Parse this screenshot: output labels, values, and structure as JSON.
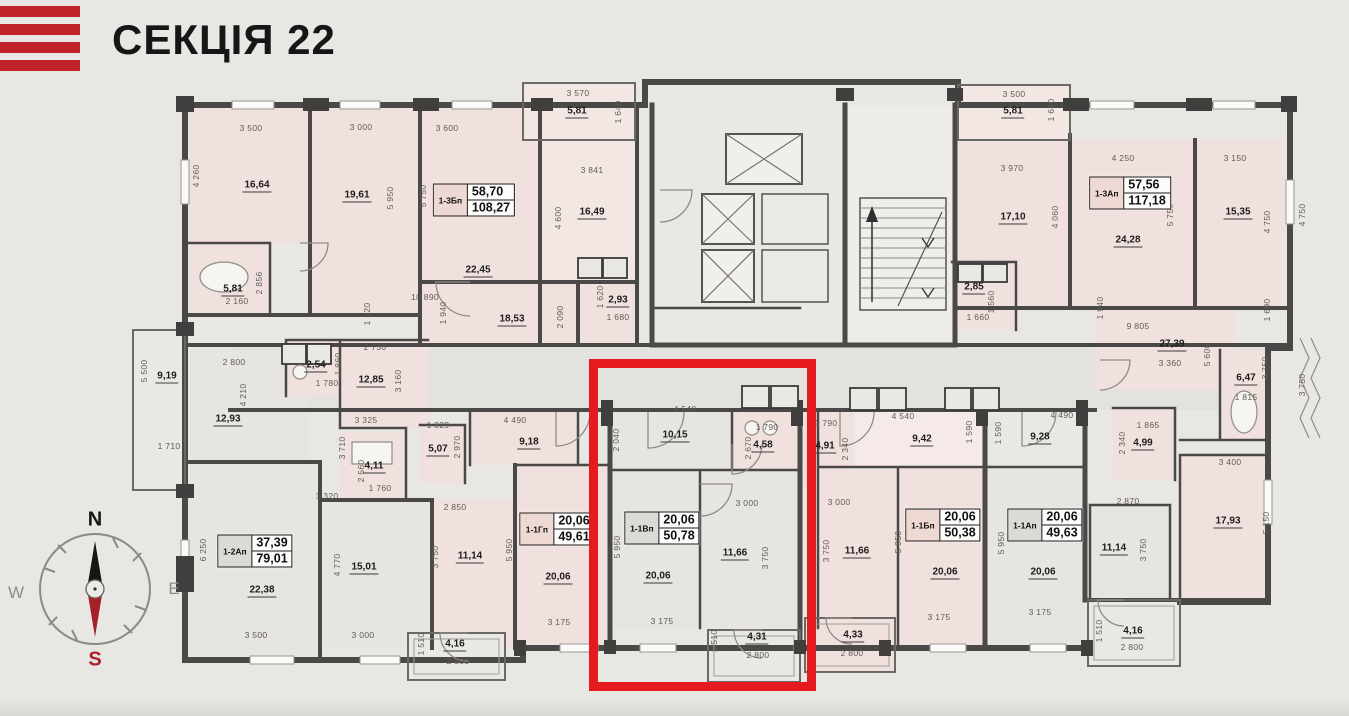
{
  "header": {
    "title": "СЕКЦІЯ 22"
  },
  "colors": {
    "highlight_red": "#e41a1f",
    "logo_red": "#bf2329",
    "room_pink": "#f1e1de",
    "room_gray": "#e6e5e1",
    "wall": "#4a4947"
  },
  "compass": {
    "n": "N",
    "s": "S",
    "w": "W",
    "e": "E"
  },
  "apartments": [
    {
      "code": "1-3Бп",
      "living": "58,70",
      "total": "108,27",
      "cell": "pink"
    },
    {
      "code": "1-3Ап",
      "living": "57,56",
      "total": "117,18",
      "cell": "pink"
    },
    {
      "code": "1-2Ап",
      "living": "37,39",
      "total": "79,01",
      "cell": "gray"
    },
    {
      "code": "1-1Гп",
      "living": "20,06",
      "total": "49,61",
      "cell": "pink"
    },
    {
      "code": "1-1Вп",
      "living": "20,06",
      "total": "50,78",
      "cell": "gray"
    },
    {
      "code": "1-1Бп",
      "living": "20,06",
      "total": "50,38",
      "cell": "pink"
    },
    {
      "code": "1-1Ап",
      "living": "20,06",
      "total": "49,63",
      "cell": "gray"
    }
  ],
  "areas": [
    "16,64",
    "19,61",
    "5,81",
    "22,45",
    "16,49",
    "18,53",
    "2,93",
    "5,81",
    "5,81",
    "17,10",
    "24,28",
    "15,35",
    "2,85",
    "9,19",
    "12,93",
    "2,54",
    "12,85",
    "4,11",
    "5,07",
    "9,18",
    "11,14",
    "20,06",
    "10,15",
    "4,58",
    "20,06",
    "11,66",
    "4,31",
    "4,91",
    "9,42",
    "11,66",
    "20,06",
    "4,33",
    "9,28",
    "20,06",
    "11,14",
    "17,93",
    "27,39",
    "6,47",
    "4,99",
    "4,16",
    "4,16",
    "15,01",
    "22,38"
  ],
  "dims": [
    "3 500",
    "3 000",
    "3 600",
    "4 260",
    "5 950",
    "5 750",
    "2 160",
    "2 856",
    "10 890",
    "1 940",
    "2 090",
    "1 620",
    "1 680",
    "3 570",
    "1 640",
    "3 841",
    "4 600",
    "5 500",
    "1 710",
    "2 800",
    "4 210",
    "1 220",
    "2 730",
    "1 780",
    "1 860",
    "3 160",
    "3 325",
    "3 710",
    "2 560",
    "1 760",
    "1 320",
    "6 250",
    "4 770",
    "3 500",
    "3 000",
    "4 490",
    "1 829",
    "2 970",
    "2 850",
    "3 750",
    "5 950",
    "1 510",
    "2 800",
    "3 175",
    "4 540",
    "2 040",
    "1 790",
    "2 670",
    "3 000",
    "5 950",
    "3 750",
    "3 175",
    "1 510",
    "2 800",
    "1 790",
    "2 340",
    "3 000",
    "3 750",
    "4 540",
    "1 590",
    "5 950",
    "3 175",
    "2 800",
    "1 590",
    "4 490",
    "5 950",
    "3 175",
    "3 500",
    "1 640",
    "3 970",
    "4 060",
    "4 250",
    "5 750",
    "3 150",
    "4 750",
    "1 560",
    "1 660",
    "1 940",
    "9 805",
    "3 360",
    "5 600",
    "1 690",
    "1 815",
    "3 750",
    "1 865",
    "2 340",
    "3 400",
    "2 870",
    "3 750",
    "5 150",
    "1 510",
    "2 800",
    "4 750",
    "3 750"
  ]
}
